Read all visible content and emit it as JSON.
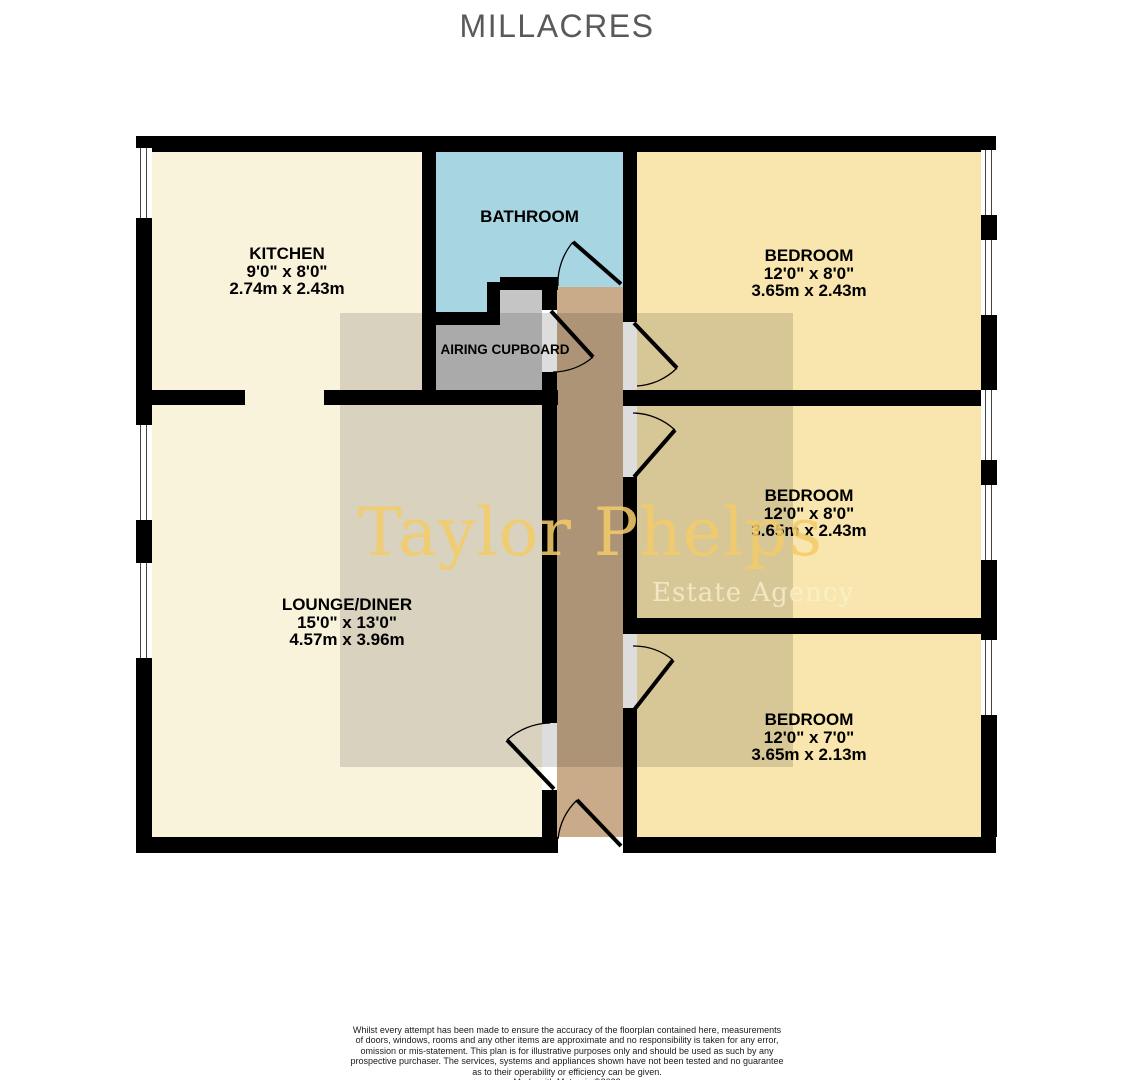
{
  "page": {
    "title": "MILLACRES"
  },
  "watermark": {
    "brand": "Taylor Phelps",
    "tagline": "Estate Agency"
  },
  "rooms": {
    "kitchen": {
      "name": "KITCHEN",
      "imperial": "9'0\"  x 8'0\"",
      "metric": "2.74m  x 2.43m"
    },
    "bathroom": {
      "name": "BATHROOM"
    },
    "airing_cupboard": {
      "name": "AIRING CUPBOARD"
    },
    "lounge_diner": {
      "name": "LOUNGE/DINER",
      "imperial": "15'0\"  x 13'0\"",
      "metric": "4.57m  x 3.96m"
    },
    "bedroom_top": {
      "name": "BEDROOM",
      "imperial": "12'0\"  x 8'0\"",
      "metric": "3.65m  x 2.43m"
    },
    "bedroom_middle": {
      "name": "BEDROOM",
      "imperial": "12'0\"  x 8'0\"",
      "metric": "3.65m  x 2.43m"
    },
    "bedroom_bottom": {
      "name": "BEDROOM",
      "imperial": "12'0\"  x 7'0\"",
      "metric": "3.65m  x 2.13m"
    }
  },
  "disclaimer": {
    "lines": [
      "Whilst every attempt has been made to ensure the accuracy of the floorplan contained here, measurements",
      "of doors, windows, rooms and any other items are approximate and no responsibility is taken for any error,",
      "omission or mis-statement. This plan is for illustrative purposes only and should be used as such by any",
      "prospective purchaser. The services, systems and appliances shown have not been tested and no guarantee",
      "as to their operability or efficiency can be given."
    ],
    "credit": "Made with Metropix ©2023"
  },
  "colors": {
    "room_cream": "#faf3dc",
    "room_yellow": "#f8e6ae",
    "bathroom_blue": "#a7d5e2",
    "cupboard_gray": "#c5c5c5",
    "hallway_tan": "#c9ab89",
    "wall_black": "#000000",
    "watermark_gold": "#f3cb69",
    "title_gray": "#58595b"
  }
}
